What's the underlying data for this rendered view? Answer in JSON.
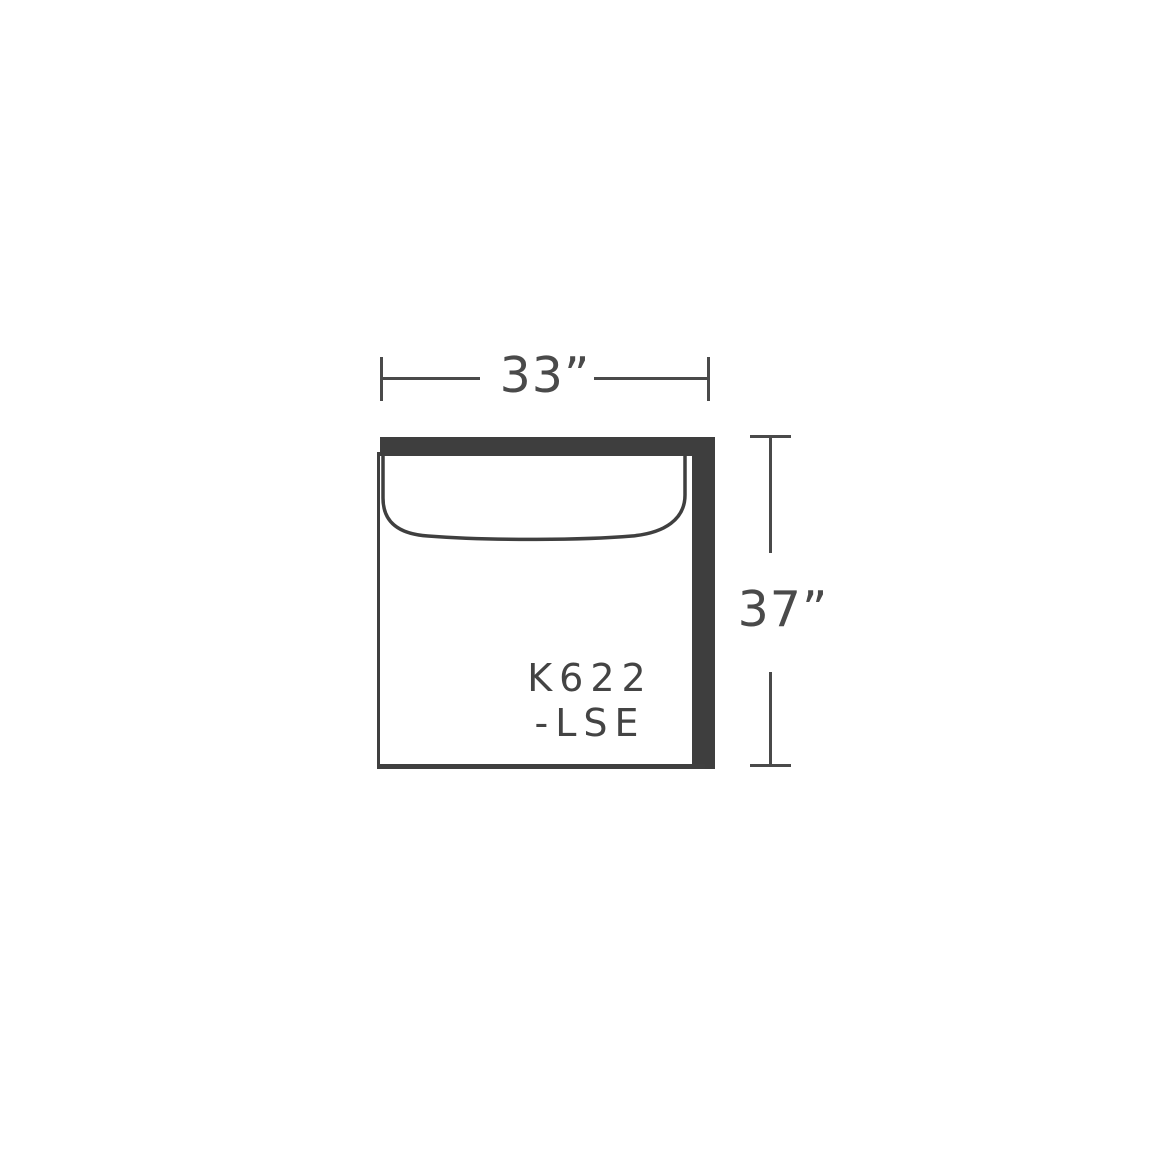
{
  "diagram": {
    "model": {
      "line1": "K622",
      "line2": "-LSE"
    },
    "dimensions": {
      "width": {
        "label": "33”",
        "value_inches": 33
      },
      "depth": {
        "label": "37”",
        "value_inches": 37
      }
    },
    "colors": {
      "ink": "#4a4a4a",
      "frame_fill": "#3e3e3e",
      "outline": "#3f3f3f",
      "background": "#ffffff"
    }
  }
}
